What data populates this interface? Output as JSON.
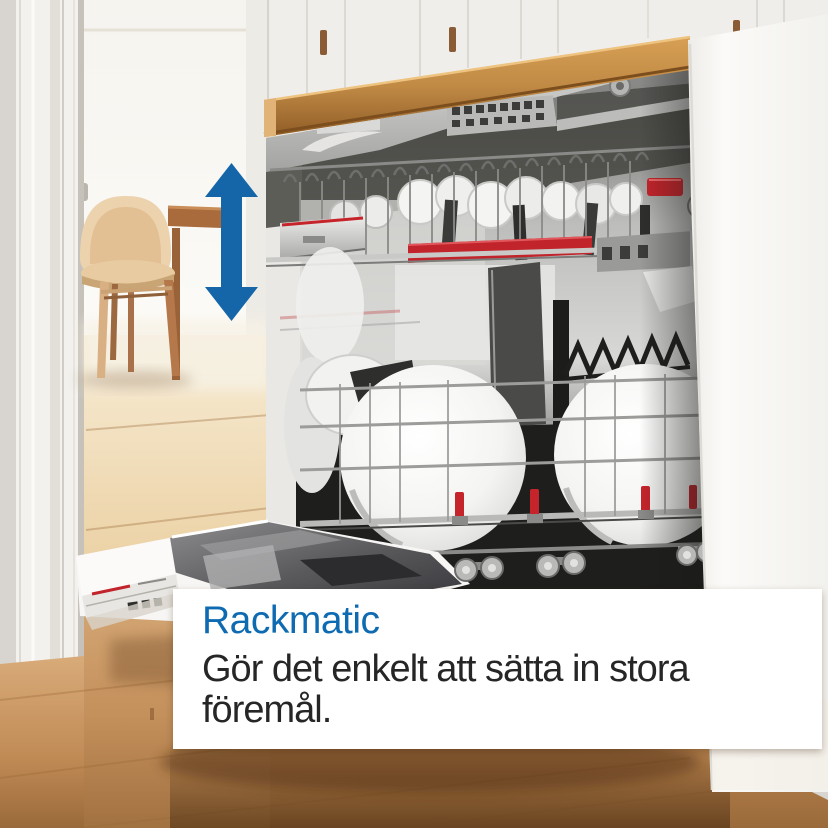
{
  "overlay": {
    "title": "Rackmatic",
    "lines": [
      "Gör det enkelt att sätta in stora",
      "föremål."
    ]
  },
  "colors": {
    "title_blue": "#0e6bb2",
    "body_text": "#262626",
    "arrow_blue": "#1566a8",
    "bosch_red": "#c6242b",
    "countertop_wood": "#c08a45",
    "floor_wood": "#c89263",
    "cabinet_white": "#f7f6f3"
  },
  "icons": {
    "height_adjust_arrow": "vertical-double-arrow-icon"
  },
  "scene": {
    "objects": [
      "left-door-frame",
      "window",
      "wooden-chair",
      "dining-table-edge",
      "oak-floor",
      "kitchen-island",
      "wood-countertop",
      "background-cabinets",
      "dishwasher-cutlery-tray",
      "dishwasher-upper-rack",
      "dishwasher-lower-rack",
      "dishwasher-open-door",
      "white-cookware"
    ]
  }
}
